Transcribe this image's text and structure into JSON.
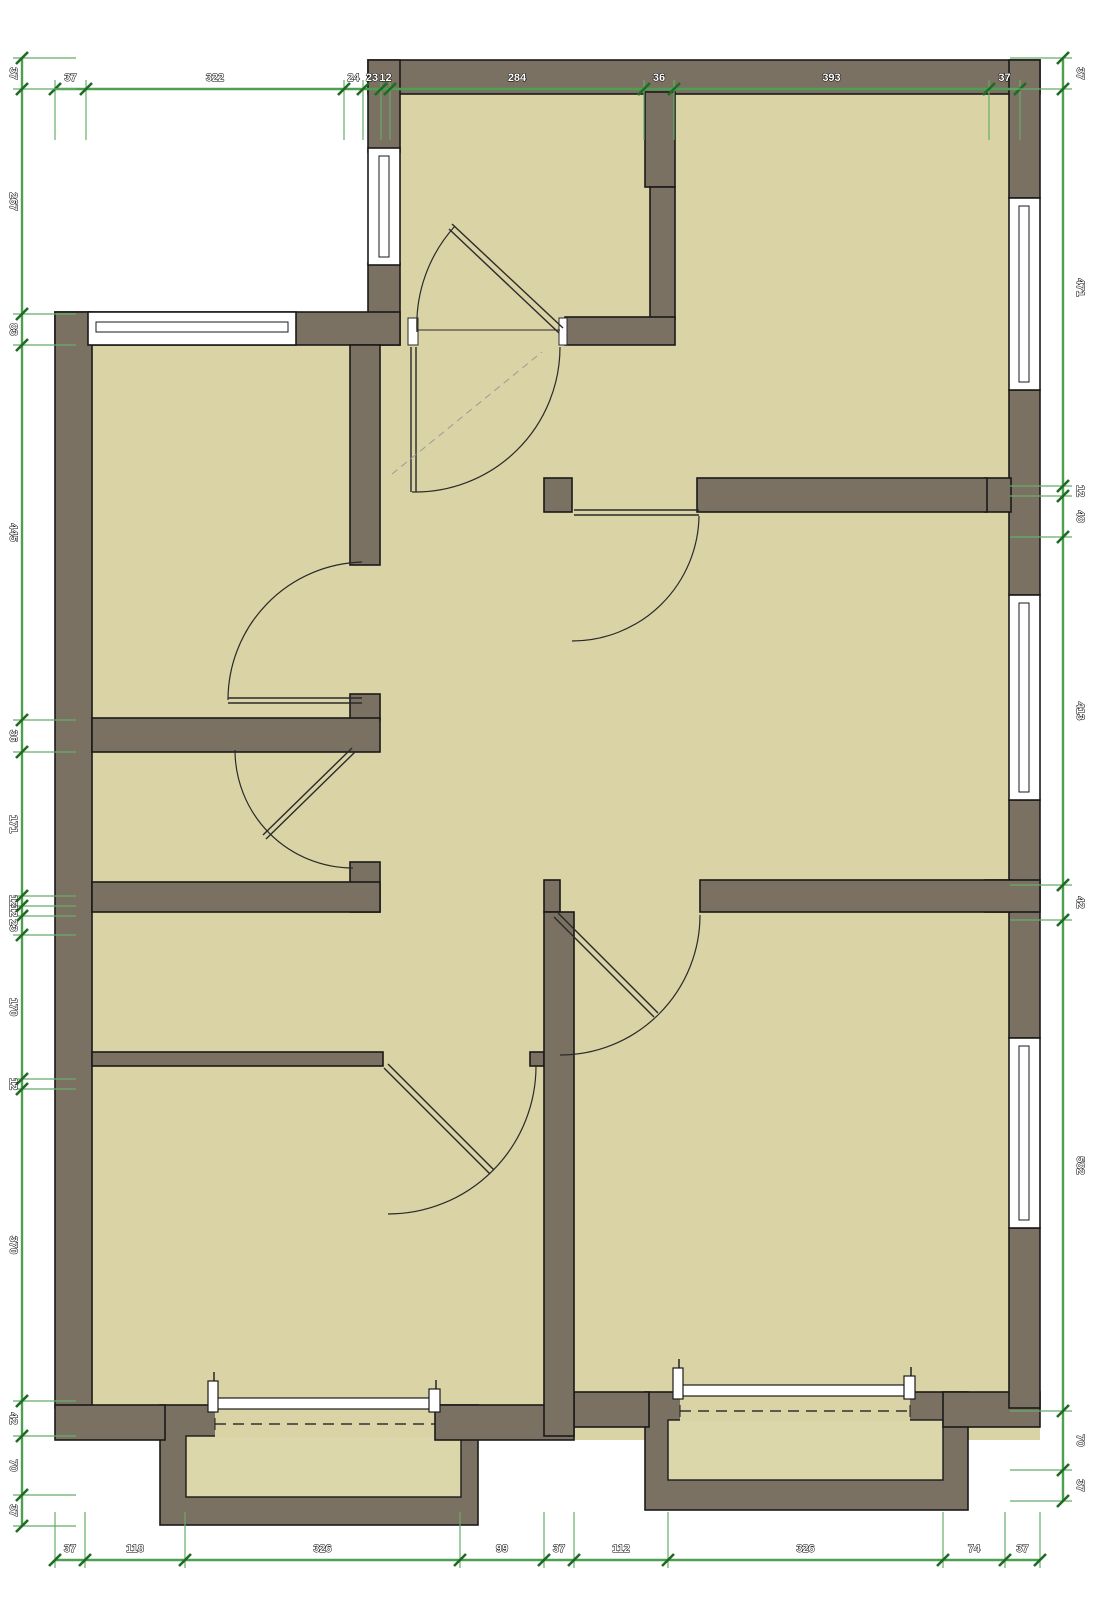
{
  "drawing": {
    "type": "floor-plan",
    "units": "cm"
  },
  "colors": {
    "background": "#ffffff",
    "wall_fill": "#7b7163",
    "wall_outline": "#1a1a1a",
    "room_fill": "#d9d3a5",
    "porch_fill": "#dcd6ab",
    "dimension_line": "#4f9f53",
    "dimension_tick": "#1f6b24",
    "dimension_extension": "#66ac68",
    "label_fill": "#ffffff",
    "label_outline": "#000000",
    "door_stroke": "#2a2a2a",
    "dashed_stroke": "#333333"
  },
  "dimensions": {
    "top": [
      "37",
      "322",
      "24",
      "23",
      "12",
      "284",
      "36",
      "393",
      "37"
    ],
    "bottom": [
      "37",
      "118",
      "326",
      "99",
      "37",
      "112",
      "326",
      "74",
      "37"
    ],
    "left": [
      "37",
      "267",
      "83",
      "445",
      "36",
      "171",
      "12",
      "12",
      "23",
      "170",
      "12",
      "370",
      "42",
      "70",
      "37"
    ],
    "right": [
      "37",
      "471",
      "12",
      "48",
      "413",
      "42",
      "582",
      "70",
      "37"
    ]
  }
}
